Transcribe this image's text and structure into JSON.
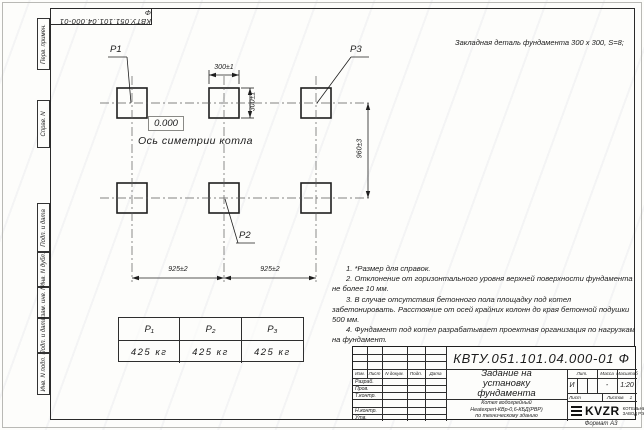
{
  "colors": {
    "ink": "#1c1c1c",
    "paper": "#fdfdfb",
    "watermark": "#7884a2"
  },
  "sheet": {
    "top_stamp": "КВТУ.051.101.04.000-01  Ф",
    "format_label": "Формат А3",
    "side_labels": [
      "Перв. примен.",
      "Справ. N",
      "Подп. и дата",
      "Инв. N дубл.",
      "Взам. инв. N",
      "Подп. и дата",
      "Инв. N подл."
    ]
  },
  "drawing": {
    "caption": "Закладная деталь фундамента  300 х 300,  S=8;",
    "level_mark": "0.000",
    "axis_label": "Ось симетрии котла",
    "point_labels": {
      "p1": "P1",
      "p2": "P2",
      "p3": "P3"
    },
    "dimensions": {
      "width_top": "300±1",
      "height_right": "300±1",
      "row_spacing": "960±3",
      "col_spacing_left": "925±2",
      "col_spacing_right": "925±2"
    }
  },
  "notes": [
    "1. *Размер для справок.",
    "2. Отклонение от горизонтального уровня верхней поверхности фундамента не более 10 мм.",
    "3. В случае отсутствия бетонного пола площадку под котел забетонировать. Расстояние от осей крайних колонн до края бетонной подушки 500 мм.",
    "4. Фундамент под котел разрабатывает проектная организация по нагрузкам на фундамент."
  ],
  "load_table": {
    "headers": [
      "P₁",
      "P₂",
      "P₃"
    ],
    "values": [
      "425 кг",
      "425 кг",
      "425 кг"
    ]
  },
  "title_block": {
    "designation": "КВТУ.051.101.04.000-01  Ф",
    "title_lines": [
      "Задание на",
      "установку",
      "фундамента"
    ],
    "product_lines": [
      "Котел водогрейный",
      "Heatexpert-КВр-0,6-КБД(РВР)",
      "по техническому зданию"
    ],
    "columns": {
      "izm": "Изм.",
      "list": "Лист",
      "doc": "N докум.",
      "sign": "Подп.",
      "date": "Дата"
    },
    "rows": [
      "Разраб.",
      "Пров.",
      "Т.контр.",
      "",
      "Н.контр.",
      "Утв."
    ],
    "lit_header": "Лит.",
    "lit_value": "И",
    "mass_header": "Масса",
    "mass_value": "-",
    "scale_header": "Масштаб",
    "scale_value": "1:20",
    "sheet_header": "Лист",
    "sheets_header": "Листов",
    "sheets_value": "1",
    "logo_text": "KVZR",
    "logo_caption_lines": [
      "КОТЕЛЬНЫЙ",
      "ЗАВОД РЭП"
    ]
  }
}
